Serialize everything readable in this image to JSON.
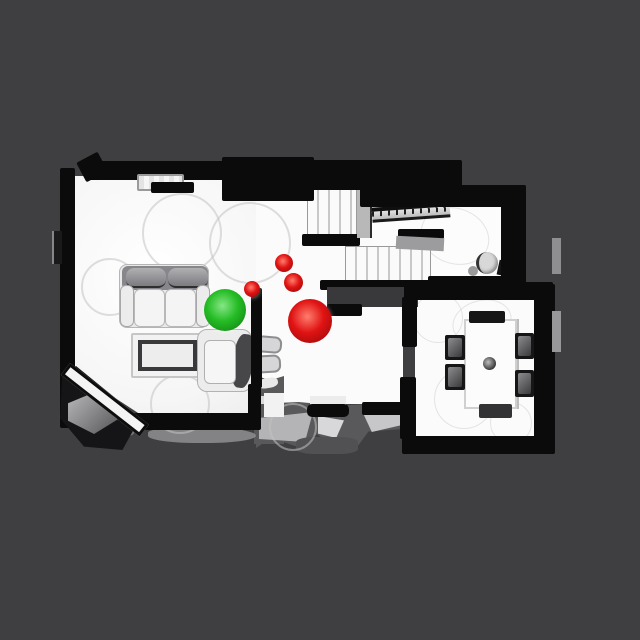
{
  "scene": {
    "description": "Top-down orthographic render of a 3D-scanned house floorplan on a dark gray background, with one green navigation sphere and four red navigation spheres",
    "background_color": "#3f3f41",
    "floor_color": "#fafafa",
    "wall_color": "#0b0b0c",
    "unscanned_color": "#59595b"
  },
  "rooms": [
    {
      "name": "living-room",
      "contents": [
        "sofa",
        "coffee-table",
        "armchair",
        "window-seat",
        "corner-piano",
        "rug-circles"
      ]
    },
    {
      "name": "center-hall",
      "contents": [
        "staircase-upper-flight",
        "staircase-lower-flight",
        "stair-railing",
        "two-stools",
        "entry-porch-unscanned-area"
      ]
    },
    {
      "name": "upper-right-room",
      "contents": [
        "round-fixture"
      ]
    },
    {
      "name": "dining-room",
      "contents": [
        "dining-table",
        "six-chairs",
        "centerpiece"
      ]
    }
  ],
  "markers": [
    {
      "name": "green-sphere-marker",
      "color": "green",
      "cx": 225,
      "cy": 310,
      "r": 21
    },
    {
      "name": "red-sphere-marker-large",
      "color": "red",
      "cx": 310,
      "cy": 321,
      "r": 22
    },
    {
      "name": "red-sphere-marker-small-1",
      "color": "red",
      "cx": 284,
      "cy": 263,
      "r": 9
    },
    {
      "name": "red-sphere-marker-small-2",
      "color": "red",
      "cx": 293,
      "cy": 282,
      "r": 9.5
    },
    {
      "name": "red-sphere-marker-small-3",
      "color": "red",
      "cx": 252,
      "cy": 289,
      "r": 8
    }
  ],
  "marker_palette": {
    "green": {
      "highlight": "#86e686",
      "base": "#25bc25",
      "dark": "#0f7a0f"
    },
    "red": {
      "highlight": "#ff7d6e",
      "base": "#e01313",
      "dark": "#8e0808"
    }
  }
}
